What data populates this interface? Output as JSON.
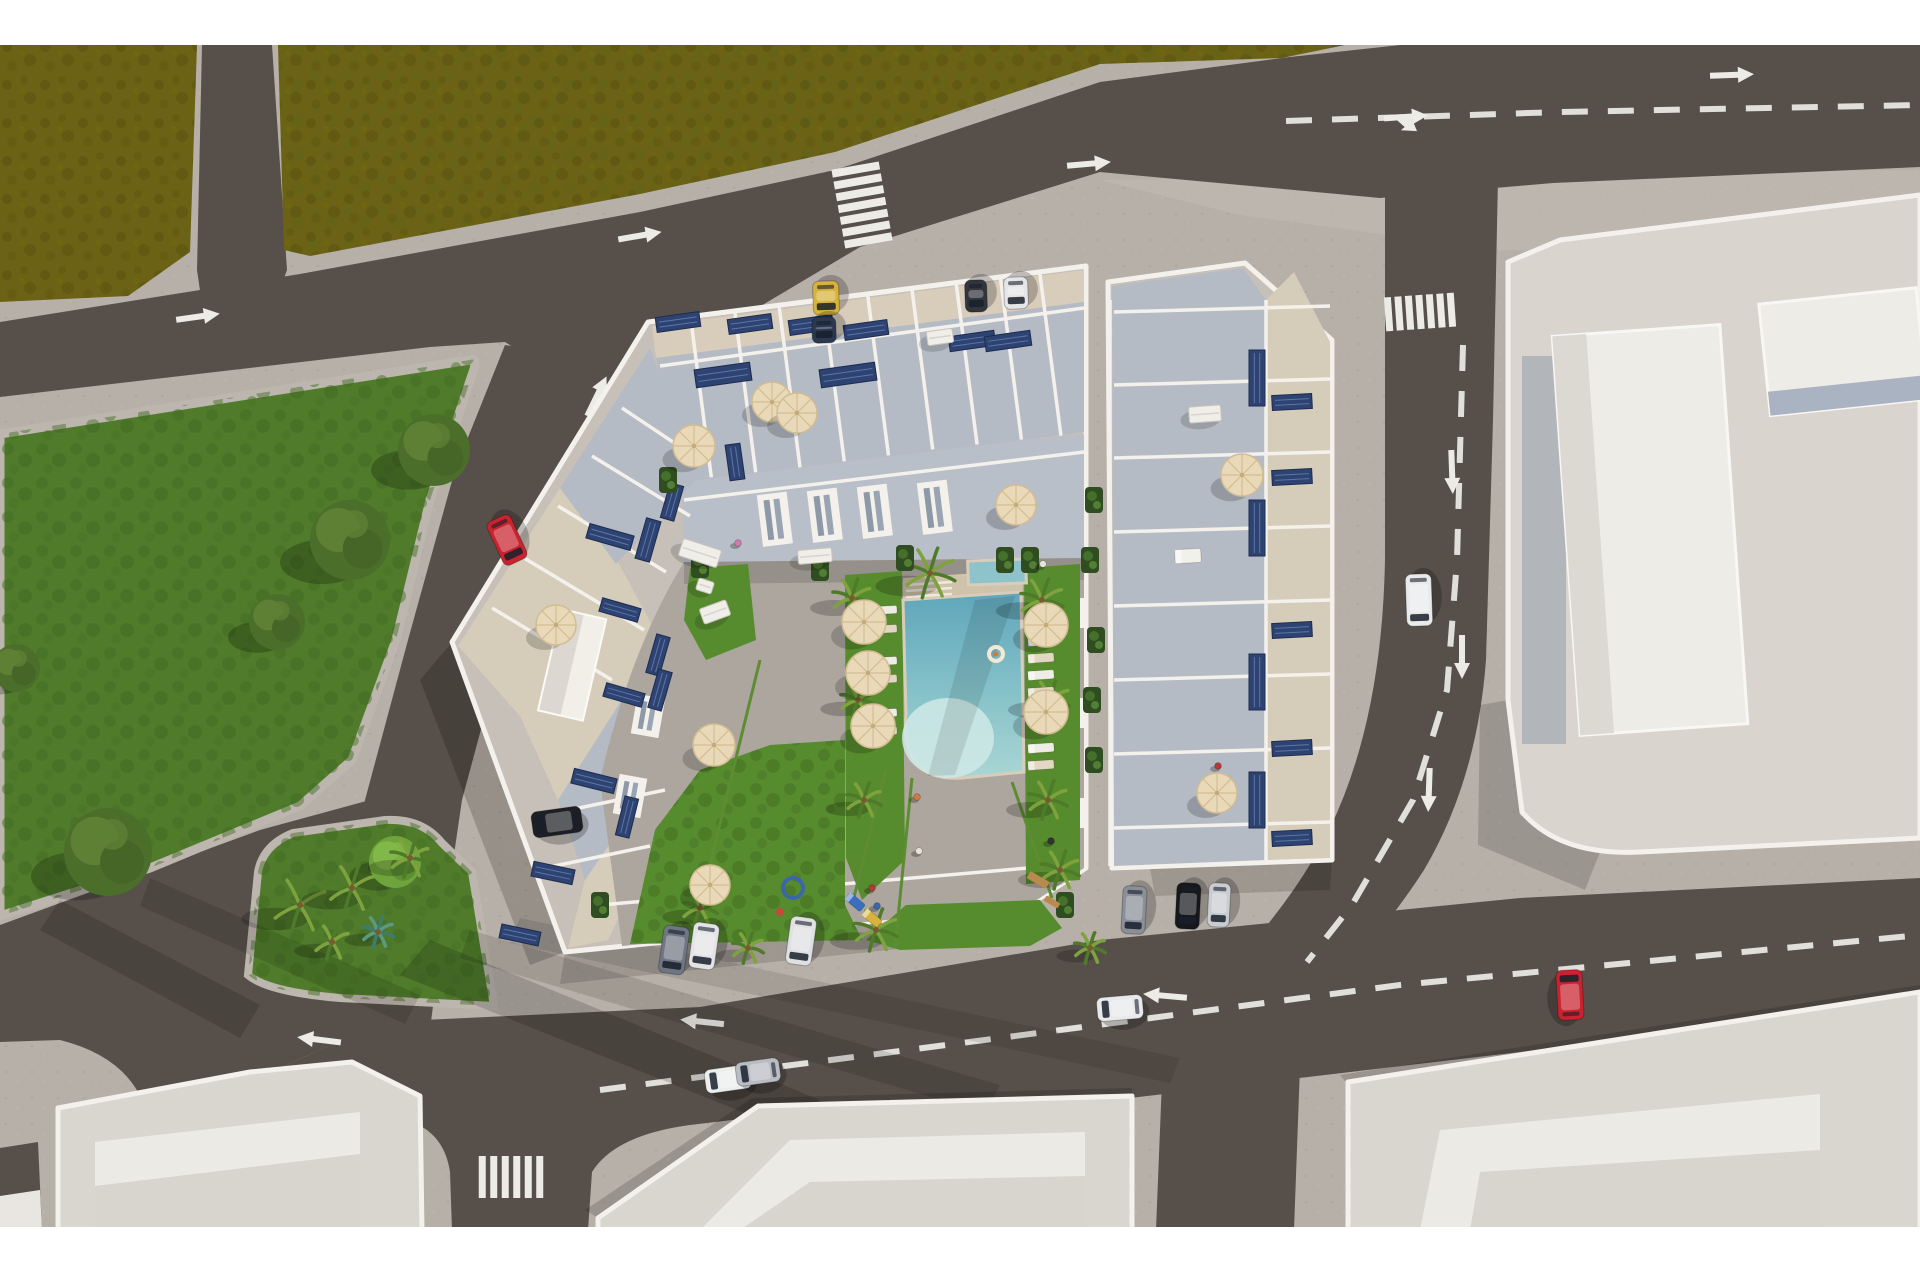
{
  "meta": {
    "title": "Aerial 3D architectural rendering of a residential apartment complex with rooftop terraces, solar panels, a courtyard swimming pool, surrounding streets, parks and neighboring buildings"
  },
  "palette": {
    "white_bar": "#ffffff",
    "sidewalk": "#b7b0a8",
    "sidewalk_light": "#c3bcb4",
    "road": "#57504a",
    "marking": "#edebe6",
    "field": "#6c6215",
    "field_dark": "#575010",
    "park": "#4f7b2b",
    "park_dark": "#3c6320",
    "lawn": "#578c2e",
    "walkway": "#aca69e",
    "wall": "#f4f1ec",
    "building_base": "#c6c0b8",
    "terrace_beige": "#d8cdbb",
    "terrace_blue": "#b5bbc5",
    "terrace_blue2": "#b9bfc9",
    "roof_light": "#e6e2dc",
    "roof_slab": "#d9d5cf",
    "pool_deep": "#64aabd",
    "pool_mid": "#9fd0d2",
    "pool_shallow": "#cfe9e6",
    "pool_deck": "#cfc3ab",
    "solar": "#2e4371",
    "solar_line": "#5b76a8",
    "umbrella": "#ead9b8",
    "umbrella_rib": "#d2bd92",
    "shrub": "#2f4d20",
    "trunk": "#7a5a33"
  },
  "objects": {
    "cars": [
      [
        507,
        540,
        155,
        26,
        48,
        "#c8232e"
      ],
      [
        826,
        298,
        178,
        26,
        34,
        "#d7b33c"
      ],
      [
        824,
        330,
        178,
        24,
        26,
        "#2c3850"
      ],
      [
        976,
        296,
        178,
        22,
        32,
        "#32353c"
      ],
      [
        1016,
        293,
        178,
        24,
        32,
        "#e6e6e8"
      ],
      [
        557,
        822,
        262,
        26,
        50,
        "#1d1f24"
      ],
      [
        674,
        950,
        188,
        26,
        48,
        "#6f7683"
      ],
      [
        704,
        946,
        188,
        26,
        46,
        "#e4e4e6"
      ],
      [
        801,
        941,
        188,
        26,
        48,
        "#dfe0e2"
      ],
      [
        1134,
        910,
        183,
        24,
        48,
        "#8a8f98"
      ],
      [
        1188,
        906,
        183,
        24,
        46,
        "#17181c"
      ],
      [
        1219,
        905,
        183,
        22,
        44,
        "#c9ccd1"
      ],
      [
        1120,
        1008,
        265,
        24,
        46,
        "#e8e9eb"
      ],
      [
        728,
        1079,
        262,
        24,
        46,
        "#eceded"
      ],
      [
        758,
        1072,
        262,
        24,
        44,
        "#b9bcc2"
      ],
      [
        1570,
        995,
        357,
        26,
        50,
        "#c8232e"
      ],
      [
        1419,
        600,
        178,
        26,
        52,
        "#e9eaec"
      ]
    ],
    "umbrellas": [
      [
        864,
        622,
        22
      ],
      [
        868,
        673,
        22
      ],
      [
        873,
        726,
        22
      ],
      [
        1046,
        625,
        22
      ],
      [
        1046,
        712,
        22
      ],
      [
        694,
        446,
        21
      ],
      [
        772,
        402,
        20
      ],
      [
        797,
        413,
        20
      ],
      [
        556,
        625,
        20
      ],
      [
        714,
        745,
        21
      ],
      [
        710,
        885,
        20
      ],
      [
        1016,
        505,
        20
      ],
      [
        1242,
        475,
        21
      ],
      [
        1217,
        793,
        20
      ]
    ],
    "solar_panels": [
      [
        678,
        322,
        44,
        15,
        -8
      ],
      [
        750,
        324,
        44,
        15,
        -8
      ],
      [
        811,
        325,
        44,
        15,
        -8
      ],
      [
        866,
        330,
        44,
        15,
        -8
      ],
      [
        723,
        375,
        56,
        18,
        -8
      ],
      [
        848,
        375,
        56,
        18,
        -8
      ],
      [
        972,
        341,
        46,
        15,
        -8
      ],
      [
        1008,
        341,
        46,
        15,
        -8
      ],
      [
        1257,
        378,
        16,
        56,
        0
      ],
      [
        1257,
        528,
        16,
        56,
        0
      ],
      [
        1257,
        682,
        16,
        56,
        0
      ],
      [
        1257,
        800,
        16,
        56,
        0
      ],
      [
        1292,
        402,
        40,
        15,
        -3
      ],
      [
        1292,
        477,
        40,
        15,
        -3
      ],
      [
        1292,
        630,
        40,
        15,
        -3
      ],
      [
        1292,
        748,
        40,
        15,
        -3
      ],
      [
        1292,
        838,
        40,
        15,
        -3
      ],
      [
        610,
        537,
        46,
        15,
        16
      ],
      [
        648,
        540,
        15,
        42,
        16
      ],
      [
        620,
        610,
        40,
        14,
        16
      ],
      [
        658,
        655,
        14,
        40,
        16
      ],
      [
        624,
        695,
        40,
        14,
        16
      ],
      [
        660,
        690,
        14,
        40,
        16
      ],
      [
        594,
        781,
        44,
        15,
        14
      ],
      [
        627,
        817,
        14,
        40,
        14
      ],
      [
        553,
        873,
        42,
        15,
        12
      ],
      [
        520,
        935,
        40,
        14,
        12
      ],
      [
        672,
        502,
        14,
        36,
        16
      ],
      [
        735,
        462,
        15,
        36,
        -8
      ]
    ],
    "trees": [
      [
        434,
        450,
        36,
        0
      ],
      [
        350,
        540,
        40,
        0
      ],
      [
        277,
        622,
        28,
        0
      ],
      [
        16,
        668,
        24,
        0
      ],
      [
        108,
        852,
        44,
        0
      ],
      [
        395,
        862,
        26,
        1
      ]
    ],
    "palms": [
      [
        300,
        905,
        28,
        0
      ],
      [
        352,
        888,
        24,
        0
      ],
      [
        410,
        858,
        20,
        0
      ],
      [
        332,
        942,
        18,
        0
      ],
      [
        378,
        932,
        16,
        1
      ],
      [
        930,
        573,
        26,
        0
      ],
      [
        852,
        598,
        20,
        0
      ],
      [
        858,
        700,
        18,
        0
      ],
      [
        864,
        800,
        18,
        0
      ],
      [
        876,
        930,
        22,
        0
      ],
      [
        1042,
        600,
        22,
        0
      ],
      [
        1050,
        700,
        20,
        0
      ],
      [
        1048,
        800,
        20,
        0
      ],
      [
        1060,
        870,
        20,
        0
      ],
      [
        700,
        908,
        18,
        0
      ],
      [
        748,
        948,
        16,
        0
      ],
      [
        1090,
        948,
        16,
        0
      ]
    ],
    "loungers": [
      [
        886,
        610,
        22,
        8,
        -3,
        "#efece6"
      ],
      [
        886,
        629,
        22,
        8,
        -3,
        "#e2d7c2"
      ],
      [
        886,
        661,
        22,
        8,
        -3,
        "#efece6"
      ],
      [
        886,
        679,
        22,
        8,
        -3,
        "#e2d7c2"
      ],
      [
        886,
        713,
        22,
        8,
        -3,
        "#efece6"
      ],
      [
        886,
        731,
        22,
        8,
        -3,
        "#e2d7c2"
      ],
      [
        1041,
        641,
        26,
        9,
        -4,
        "#efece6"
      ],
      [
        1041,
        658,
        26,
        9,
        -4,
        "#e2d7c2"
      ],
      [
        1041,
        675,
        26,
        9,
        -4,
        "#efece6"
      ],
      [
        1041,
        692,
        26,
        9,
        -4,
        "#e2d7c2"
      ],
      [
        1041,
        748,
        26,
        9,
        -4,
        "#efece6"
      ],
      [
        1041,
        765,
        26,
        9,
        -4,
        "#e2d7c2"
      ],
      [
        1188,
        556,
        26,
        14,
        -3,
        "#f2f0ea"
      ],
      [
        855,
        902,
        20,
        9,
        40,
        "#3a6fc0"
      ],
      [
        872,
        918,
        20,
        9,
        40,
        "#d8b23a"
      ]
    ],
    "tables": [
      [
        700,
        553,
        40,
        18,
        18
      ],
      [
        705,
        586,
        16,
        12,
        18
      ],
      [
        815,
        556,
        34,
        14,
        -5
      ],
      [
        1205,
        414,
        32,
        16,
        -4
      ],
      [
        715,
        612,
        28,
        16,
        -20
      ],
      [
        940,
        337,
        26,
        14,
        -8
      ]
    ],
    "shrubs": [
      [
        1094,
        500
      ],
      [
        1096,
        640
      ],
      [
        1094,
        760
      ],
      [
        1090,
        560
      ],
      [
        1092,
        700
      ],
      [
        700,
        565
      ],
      [
        820,
        568
      ],
      [
        1005,
        560
      ],
      [
        668,
        480
      ],
      [
        905,
        558
      ],
      [
        1030,
        560
      ],
      [
        600,
        905
      ],
      [
        1065,
        905
      ]
    ],
    "people": [
      [
        738,
        543,
        "#cf7ab0"
      ],
      [
        917,
        797,
        "#cf7a3e"
      ],
      [
        1043,
        564,
        "#e8e4da"
      ],
      [
        872,
        888,
        "#b33a35"
      ],
      [
        877,
        906,
        "#3c66a8"
      ],
      [
        919,
        851,
        "#e8e4da"
      ],
      [
        1051,
        841,
        "#333333"
      ],
      [
        1218,
        766,
        "#b33a35"
      ]
    ],
    "pool_float": [
      996,
      654,
      7
    ],
    "playground": [
      {
        "type": "ring",
        "x": 793,
        "y": 888,
        "r": 10,
        "color": "#3c66a8"
      },
      {
        "type": "rect",
        "x": 1038,
        "y": 880,
        "w": 22,
        "h": 8,
        "rot": 30,
        "color": "#b98a4e"
      },
      {
        "type": "rect",
        "x": 1052,
        "y": 902,
        "w": 16,
        "h": 6,
        "rot": 30,
        "color": "#b98a4e"
      },
      {
        "type": "dot",
        "x": 780,
        "y": 912,
        "r": 4,
        "color": "#c24b3a"
      }
    ],
    "arrows": [
      [
        196,
        317,
        -8,
        0
      ],
      [
        638,
        236,
        -10,
        0
      ],
      [
        1087,
        164,
        -5,
        0
      ],
      [
        1404,
        117,
        -4,
        1
      ],
      [
        1730,
        75,
        -2,
        0
      ],
      [
        1452,
        470,
        88,
        0
      ],
      [
        1462,
        655,
        90,
        0
      ],
      [
        1429,
        788,
        92,
        0
      ],
      [
        596,
        398,
        -64,
        0
      ],
      [
        478,
        632,
        -64,
        0
      ],
      [
        321,
        1040,
        187,
        0
      ],
      [
        704,
        1022,
        186,
        0
      ],
      [
        1167,
        996,
        185,
        0
      ]
    ],
    "crosswalks": [
      {
        "x": 862,
        "y": 205,
        "rot": -10,
        "mode": "stack",
        "count": 7,
        "sw": 48,
        "sh": 8,
        "gap": 4
      },
      {
        "x": 1420,
        "y": 312,
        "rot": -4,
        "mode": "row",
        "count": 7,
        "sw": 7,
        "sh": 34,
        "gap": 3.5
      },
      {
        "x": 511,
        "y": 1177,
        "rot": 0,
        "mode": "row",
        "count": 6,
        "sw": 7,
        "sh": 42,
        "gap": 4.5
      }
    ],
    "dash_lines": [
      [
        [
          1286,
          121
        ],
        [
          1560,
          112
        ],
        [
          1920,
          105
        ]
      ],
      [
        [
          1463,
          345
        ],
        [
          1457,
          560
        ],
        [
          1447,
          690
        ],
        [
          1413,
          800
        ],
        [
          1352,
          905
        ],
        [
          1307,
          962
        ]
      ],
      [
        [
          600,
          1090
        ],
        [
          1000,
          1038
        ],
        [
          1400,
          985
        ],
        [
          1920,
          935
        ]
      ]
    ]
  }
}
